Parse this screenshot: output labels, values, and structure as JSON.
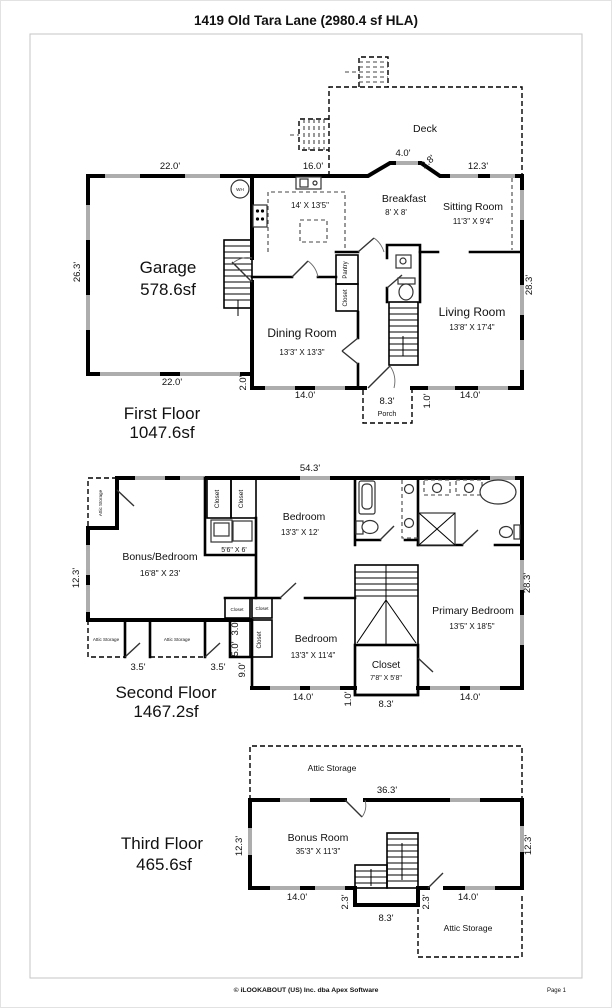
{
  "page": {
    "title": "1419 Old Tara Lane (2980.4 sf HLA)",
    "footer": "© iLOOKABOUT (US) Inc. dba Apex Software",
    "page_num": "Page 1"
  },
  "floor1": {
    "title": "First Floor",
    "area": "1047.6sf",
    "garage": "Garage",
    "garage_area": "578.6sf",
    "kitchen_dims": "14' X 13'5\"",
    "breakfast": "Breakfast",
    "breakfast_dims": "8' X 8'",
    "sitting": "Sitting Room",
    "sitting_dims": "11'3\" X 9'4\"",
    "living": "Living Room",
    "living_dims": "13'8\" X 17'4\"",
    "dining": "Dining Room",
    "dining_dims": "13'3\" X 13'3\"",
    "deck": "Deck",
    "porch": "Porch",
    "pantry": "Pantry",
    "closet": "Closet",
    "wh": "WH",
    "d_top_garage": "22.0'",
    "d_top_kitchen": "16.0'",
    "d_deck1": "4.0'",
    "d_deck2": "2.8'",
    "d_deck3": "12.3'",
    "d_left": "26.3'",
    "d_right": "28.3'",
    "d_bot_garage": "22.0'",
    "d_jog": "2.0'",
    "d_bot_dining": "14.0'",
    "d_porch": "8.3'",
    "d_porch_depth": "1.0'",
    "d_bot_living": "14.0'"
  },
  "floor2": {
    "title": "Second Floor",
    "area": "1467.2sf",
    "bonus": "Bonus/Bedroom",
    "bonus_dims": "16'8\" X 23'",
    "bedroom1": "Bedroom",
    "bedroom1_dims": "13'3\" X 12'",
    "laundry_dims": "5'6\" X 6'",
    "primary": "Primary Bedroom",
    "primary_dims": "13'5\" X 18'5\"",
    "bedroom2": "Bedroom",
    "bedroom2_dims": "13'3\" X 11'4\"",
    "closet": "Closet",
    "closet_dims": "7'8\" X 5'8\"",
    "attic": "Attic Storage",
    "d_top": "54.3'",
    "d_left": "12.3'",
    "d_right": "28.3'",
    "d_attic1": "3.5'",
    "d_attic2": "3.5'",
    "d_jog1": "3.0'",
    "d_jog2": "5.0'",
    "d_jog3": "9.0'",
    "d_bot1": "14.0'",
    "d_bot_jog": "1.0'",
    "d_bot2": "8.3'",
    "d_bot3": "14.0'"
  },
  "floor3": {
    "title": "Third Floor",
    "area": "465.6sf",
    "bonus": "Bonus Room",
    "bonus_dims": "35'3\" X 11'3\"",
    "attic": "Attic Storage",
    "d_top": "36.3'",
    "d_left": "12.3'",
    "d_right": "12.3'",
    "d_bot1": "14.0'",
    "d_jog1": "2.3'",
    "d_bot2": "8.3'",
    "d_jog2": "2.3'",
    "d_bot3": "14.0'"
  }
}
